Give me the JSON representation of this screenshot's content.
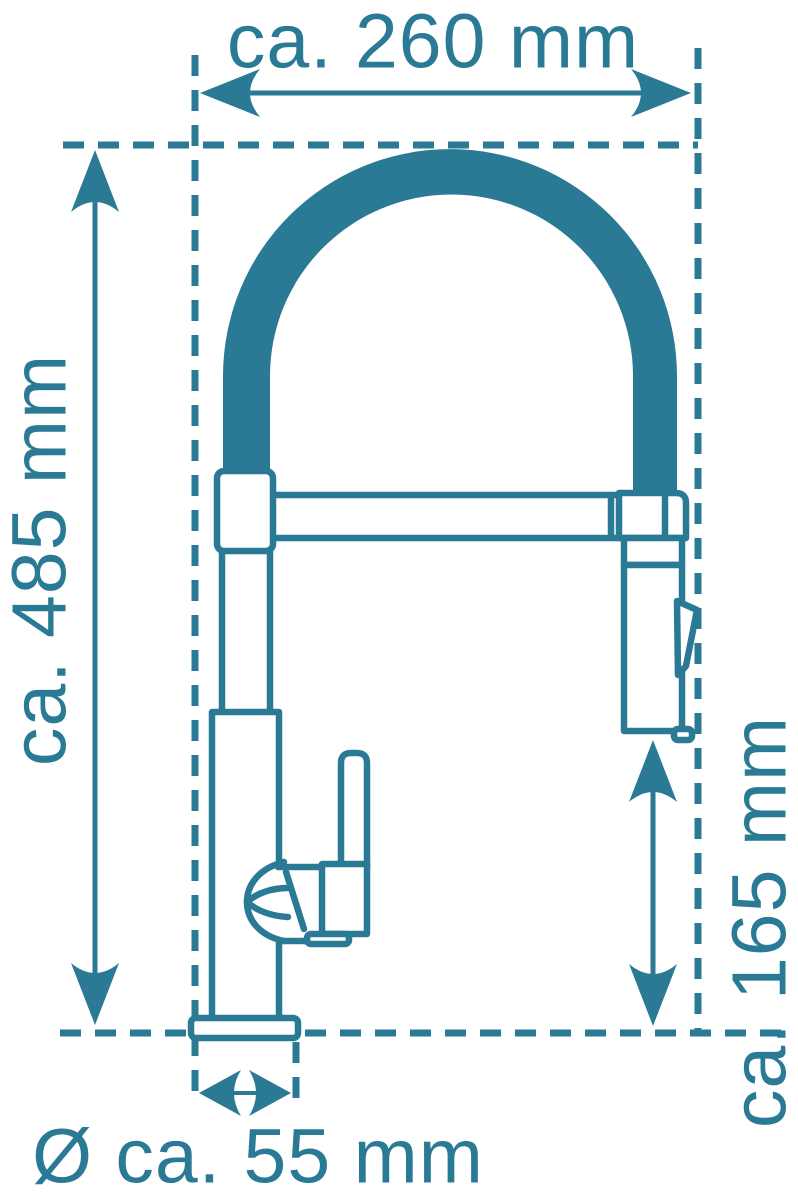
{
  "colors": {
    "line": "#2a7a96",
    "background": "#ffffff"
  },
  "dimensions": {
    "top_width": {
      "label": "ca. 260 mm"
    },
    "left_height": {
      "label": "ca. 485 mm"
    },
    "right_spray_height": {
      "label": "ca. 165 mm"
    },
    "bottom_base_diameter": {
      "label": "Ø ca. 55 mm"
    }
  }
}
